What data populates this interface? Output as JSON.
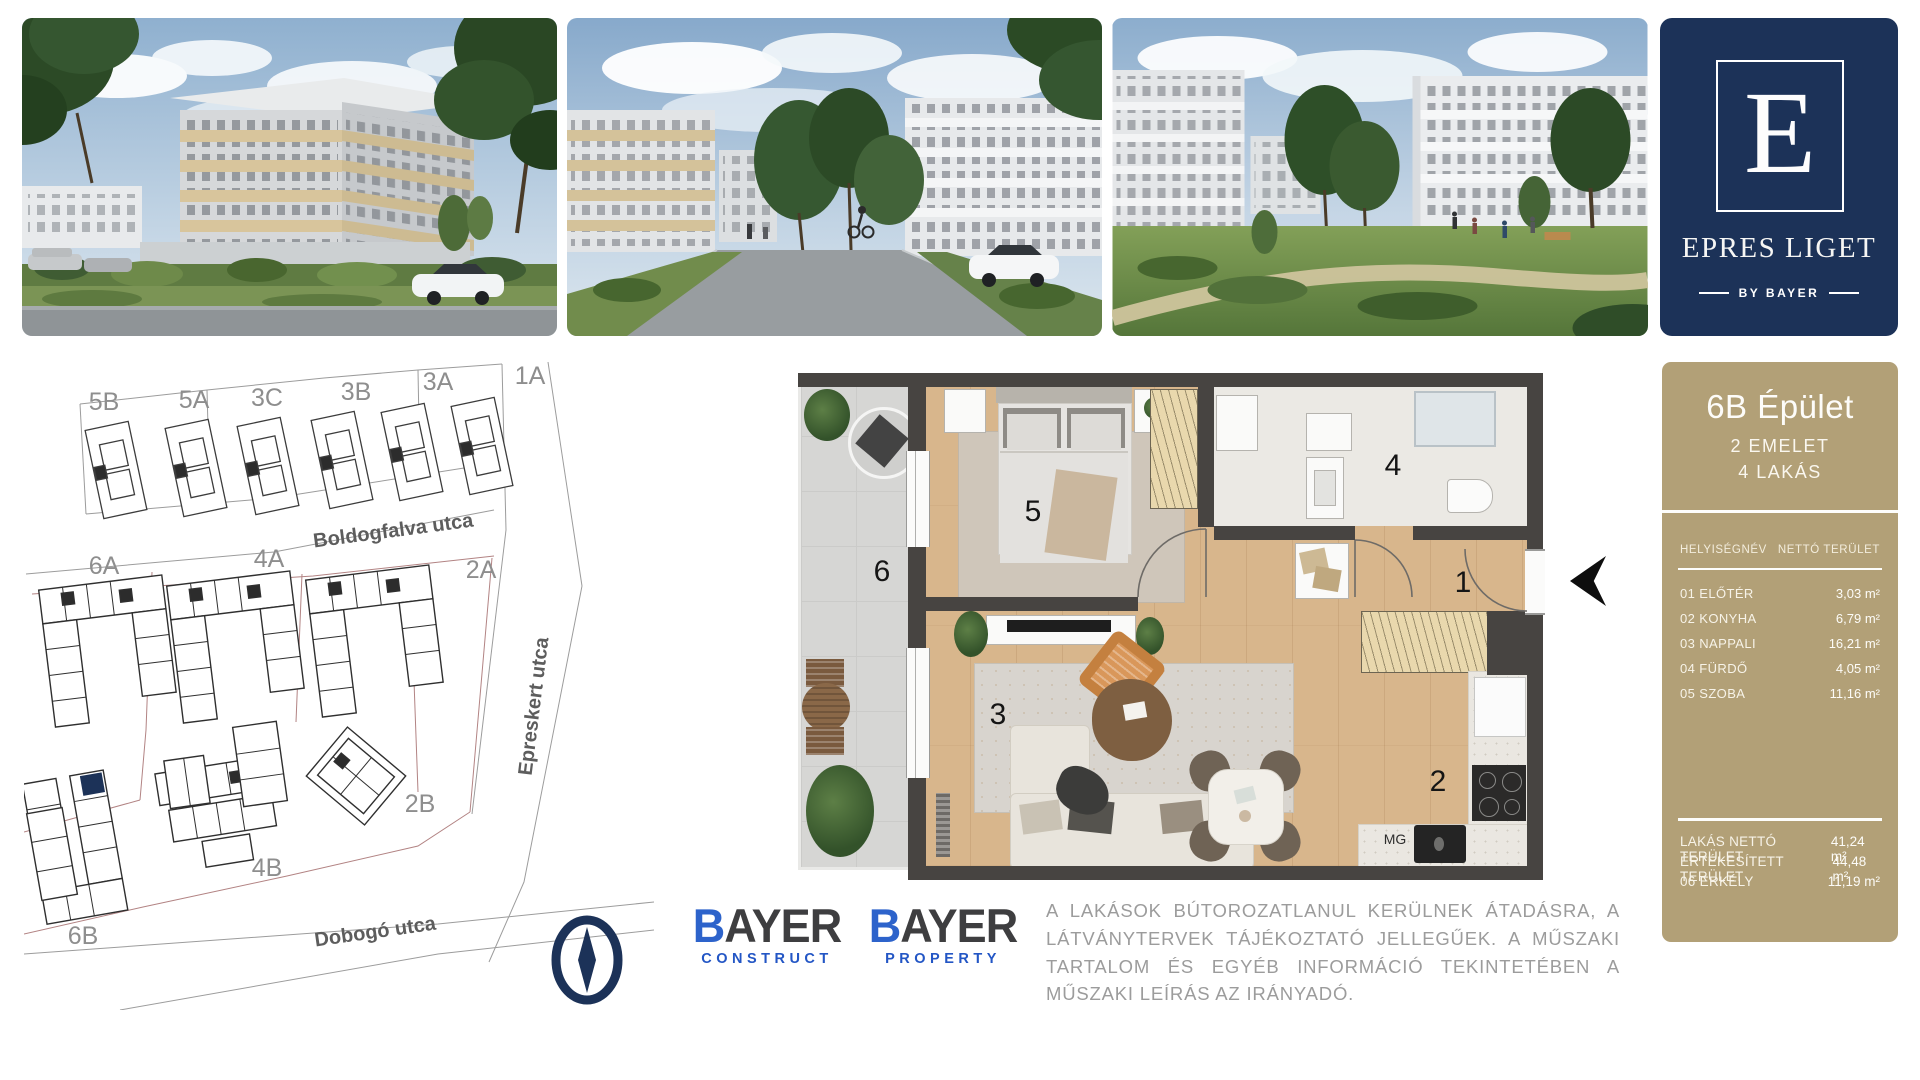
{
  "brand": {
    "logo_letter": "E",
    "name": "EPRES LIGET",
    "byline": "BY BAYER"
  },
  "site_plan": {
    "building_labels": [
      "5B",
      "5A",
      "3C",
      "3B",
      "3A",
      "1A",
      "6A",
      "4A",
      "2A",
      "2B",
      "4B",
      "6B"
    ],
    "street_names": [
      "Boldogfalva utca",
      "Epreskert utca",
      "Dobogó utca"
    ]
  },
  "floor_plan": {
    "room_numbers": [
      "1",
      "2",
      "3",
      "4",
      "5",
      "6"
    ],
    "washing_machine_label": "MG"
  },
  "info_panel": {
    "title": "6B Épület",
    "floor_line": "2 EMELET",
    "units_line": "4 LAKÁS",
    "table": {
      "header_name": "HELYISÉGNÉV",
      "header_area": "NETTÓ TERÜLET",
      "rows": [
        {
          "name": "01 ELŐTÉR",
          "area": "3,03 m²"
        },
        {
          "name": "02 KONYHA",
          "area": "6,79 m²"
        },
        {
          "name": "03 NAPPALI",
          "area": "16,21 m²"
        },
        {
          "name": "04 FÜRDŐ",
          "area": "4,05 m²"
        },
        {
          "name": "05 SZOBA",
          "area": "11,16 m²"
        }
      ]
    },
    "summary": [
      {
        "name": "LAKÁS NETTÓ TERÜLET",
        "area": "41,24 m²"
      },
      {
        "name": "ÉRTÉKESÍTETT TERÜLET",
        "area": "44,48 m²"
      },
      {
        "name": "06 ERKÉLY",
        "area": "11,19 m²"
      }
    ]
  },
  "logos": {
    "construct": {
      "brand_initial": "B",
      "brand_rest": "AYER",
      "division": "CONSTRUCT"
    },
    "property": {
      "brand_initial": "B",
      "brand_rest": "AYER",
      "division": "PROPERTY"
    }
  },
  "disclaimer": "A LAKÁSOK BÚTOROZATLANUL KERÜLNEK ÁTADÁSRA, A LÁTVÁNYTERVEK TÁJÉKOZTATÓ JELLEGŰEK. A MŰSZAKI TARTALOM ÉS EGYÉB INFORMÁCIÓ TEKINTETÉBEN A MŰSZAKI LEÍRÁS AZ IRÁNYADÓ.",
  "colors": {
    "navy": "#1c3258",
    "tan": "#b2a077",
    "bayer_blue": "#2d63cb",
    "wall": "#474441",
    "highlight_unit": "#1c3258"
  }
}
